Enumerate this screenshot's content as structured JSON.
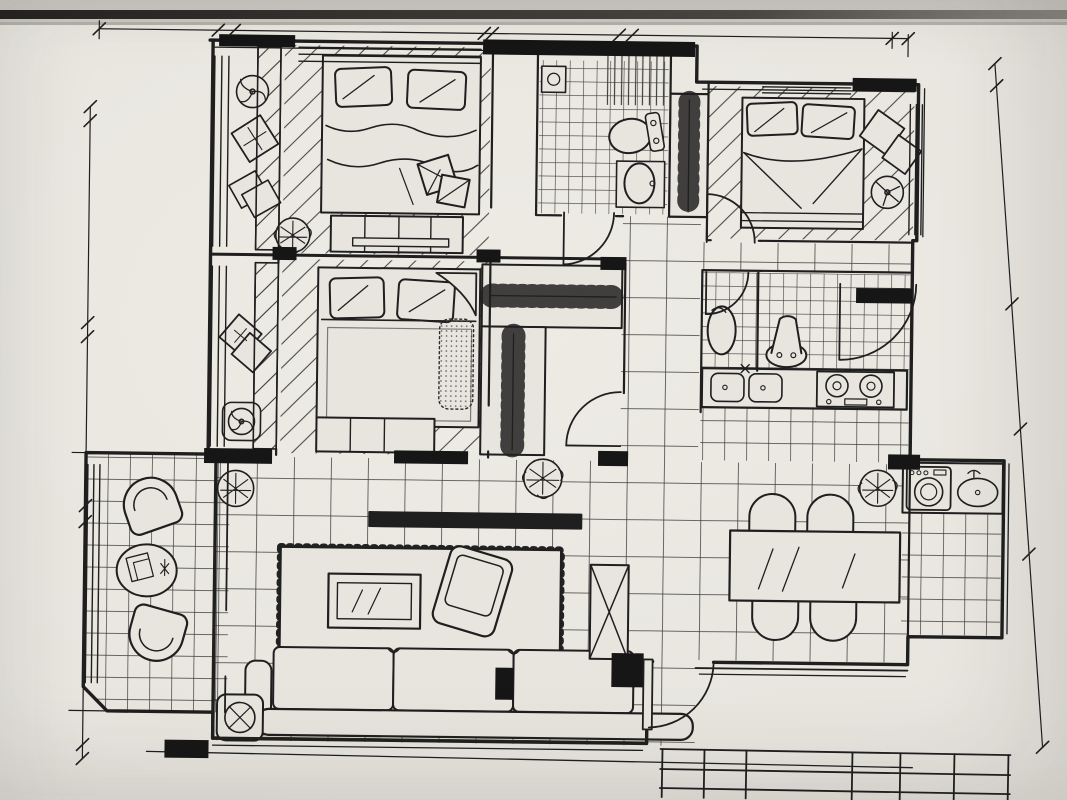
{
  "photo": {
    "paper_color": "#e8e5df",
    "ink_color": "#1f1f1f",
    "tile_line_color": "#2a2a2a"
  },
  "dims": {
    "top_overall": "11780",
    "top": [
      "1780",
      "240",
      "4970",
      "120",
      "1970",
      "200",
      "4030",
      "240"
    ],
    "left": [
      "240",
      "3580",
      "250",
      "2995",
      "285",
      "3960",
      "240"
    ],
    "left_overall": "11550",
    "right": [
      "290",
      "2830",
      "1620",
      "1610",
      "2510"
    ]
  },
  "title_block": {
    "rows": 3,
    "columns": 6
  }
}
